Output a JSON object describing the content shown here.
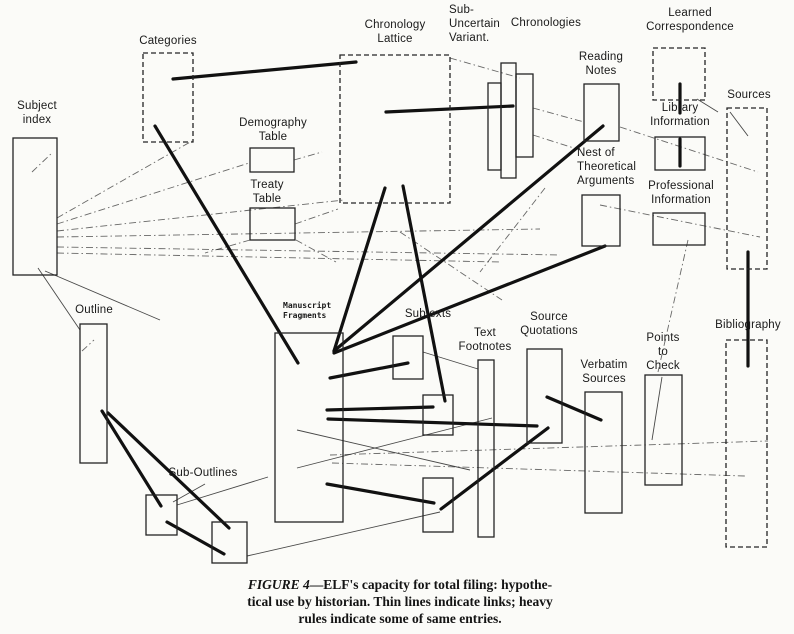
{
  "colors": {
    "paper": "#fbfbf8",
    "ink": "#1b1b1b"
  },
  "caption": {
    "figure_label": "FIGURE 4",
    "dash": "—",
    "line1_rest": "ELF's capacity for total filing: hypothe-",
    "line2": "tical use by historian. Thin lines indicate links; heavy",
    "line3": "rules indicate some of same entries."
  },
  "diagram": {
    "nodes": [
      {
        "id": "subject-index",
        "label": "Subject\nindex",
        "lx": 6,
        "ly": 100,
        "lw": 62,
        "boxes": [
          [
            13,
            138,
            44,
            137,
            0
          ]
        ]
      },
      {
        "id": "categories",
        "label": "Categories",
        "lx": 136,
        "ly": 35,
        "lw": 64,
        "boxes": [
          [
            143,
            53,
            50,
            89,
            1
          ]
        ]
      },
      {
        "id": "demography-table",
        "label": "Demography\nTable",
        "lx": 234,
        "ly": 117,
        "lw": 78,
        "boxes": [
          [
            250,
            148,
            44,
            24,
            0
          ]
        ]
      },
      {
        "id": "treaty-table",
        "label": "Treaty\nTable",
        "lx": 238,
        "ly": 179,
        "lw": 58,
        "boxes": [
          [
            250,
            208,
            45,
            32,
            0
          ]
        ]
      },
      {
        "id": "chronology-lattice",
        "label": "Chronology\nLattice",
        "lx": 338,
        "ly": 19,
        "lw": 114,
        "boxes": [
          [
            340,
            55,
            110,
            148,
            1
          ]
        ]
      },
      {
        "id": "sub-uncertain-variant",
        "label": "Sub-\nUncertain\nVariant.",
        "lx": 449,
        "ly": 4,
        "lw": 62,
        "align": "left",
        "boxes": []
      },
      {
        "id": "chronologies",
        "label": "Chronologies",
        "lx": 506,
        "ly": 17,
        "lw": 80,
        "boxes": [
          [
            488,
            83,
            13,
            87,
            0
          ],
          [
            501,
            63,
            15,
            115,
            0
          ],
          [
            516,
            74,
            17,
            83,
            0
          ]
        ]
      },
      {
        "id": "reading-notes",
        "label": "Reading\nNotes",
        "lx": 570,
        "ly": 51,
        "lw": 62,
        "boxes": [
          [
            584,
            84,
            35,
            57,
            0
          ]
        ]
      },
      {
        "id": "learned-correspondence",
        "label": "Learned\nCorrespondence",
        "lx": 640,
        "ly": 7,
        "lw": 100,
        "boxes": [
          [
            653,
            48,
            52,
            52,
            1
          ]
        ]
      },
      {
        "id": "library-information",
        "label": "Library\nInformation",
        "lx": 642,
        "ly": 102,
        "lw": 76,
        "boxes": [
          [
            655,
            137,
            50,
            33,
            0
          ]
        ]
      },
      {
        "id": "sources",
        "label": "Sources",
        "lx": 722,
        "ly": 89,
        "lw": 54,
        "boxes": [
          [
            727,
            108,
            40,
            161,
            1
          ]
        ]
      },
      {
        "id": "professional-information",
        "label": "Professional\nInformation",
        "lx": 640,
        "ly": 180,
        "lw": 82,
        "boxes": [
          [
            653,
            213,
            52,
            32,
            0
          ]
        ]
      },
      {
        "id": "nest-of-theoretical-arguments",
        "label": "Nest of\nTheoretical\nArguments",
        "lx": 577,
        "ly": 147,
        "lw": 72,
        "align": "left",
        "boxes": [
          [
            582,
            195,
            38,
            51,
            0
          ]
        ]
      },
      {
        "id": "manuscript-fragments",
        "label": "Manuscript\nFragments",
        "lx": 283,
        "ly": 301,
        "lw": 60,
        "align": "left",
        "mono": true,
        "boxes": [
          [
            275,
            333,
            68,
            189,
            0
          ]
        ]
      },
      {
        "id": "subtexts",
        "label": "Subtexts",
        "lx": 398,
        "ly": 308,
        "lw": 60,
        "boxes": [
          [
            393,
            336,
            30,
            43,
            0
          ],
          [
            423,
            395,
            30,
            40,
            0
          ],
          [
            423,
            478,
            30,
            54,
            0
          ]
        ]
      },
      {
        "id": "text-footnotes",
        "label": "Text\nFootnotes",
        "lx": 452,
        "ly": 327,
        "lw": 66,
        "boxes": [
          [
            478,
            360,
            16,
            177,
            0
          ]
        ]
      },
      {
        "id": "source-quotations",
        "label": "Source\nQuotations",
        "lx": 515,
        "ly": 311,
        "lw": 68,
        "boxes": [
          [
            527,
            349,
            35,
            94,
            0
          ]
        ]
      },
      {
        "id": "verbatim-sources",
        "label": "Verbatim\nSources",
        "lx": 572,
        "ly": 359,
        "lw": 64,
        "boxes": [
          [
            585,
            392,
            37,
            121,
            0
          ]
        ]
      },
      {
        "id": "points-to-check",
        "label": "Points\nto\nCheck",
        "lx": 638,
        "ly": 332,
        "lw": 50,
        "boxes": [
          [
            645,
            375,
            37,
            110,
            0
          ]
        ]
      },
      {
        "id": "bibliography",
        "label": "Bibliography",
        "lx": 708,
        "ly": 319,
        "lw": 80,
        "boxes": [
          [
            726,
            340,
            41,
            207,
            1
          ]
        ]
      },
      {
        "id": "outline",
        "label": "Outline",
        "lx": 68,
        "ly": 304,
        "lw": 52,
        "boxes": [
          [
            80,
            324,
            27,
            139,
            0
          ]
        ]
      },
      {
        "id": "sub-outlines",
        "label": "Sub-Outlines",
        "lx": 162,
        "ly": 467,
        "lw": 82,
        "boxes": [
          [
            146,
            495,
            31,
            40,
            0
          ],
          [
            212,
            522,
            35,
            41,
            0
          ]
        ]
      }
    ],
    "heavy_lines": [
      [
        173,
        79,
        356,
        62
      ],
      [
        155,
        126,
        298,
        363
      ],
      [
        386,
        112,
        513,
        106
      ],
      [
        385,
        188,
        334,
        351
      ],
      [
        403,
        186,
        445,
        401
      ],
      [
        334,
        351,
        603,
        126
      ],
      [
        334,
        353,
        605,
        246
      ],
      [
        330,
        378,
        408,
        363
      ],
      [
        327,
        410,
        433,
        407
      ],
      [
        328,
        419,
        537,
        426
      ],
      [
        327,
        484,
        434,
        503
      ],
      [
        441,
        509,
        548,
        428
      ],
      [
        547,
        397,
        601,
        420
      ],
      [
        680,
        84,
        680,
        113
      ],
      [
        680,
        139,
        680,
        166
      ],
      [
        748,
        252,
        748,
        366
      ],
      [
        102,
        411,
        161,
        506
      ],
      [
        108,
        413,
        229,
        528
      ],
      [
        167,
        522,
        224,
        554
      ]
    ],
    "thin_lines": [
      [
        57,
        218,
        192,
        141,
        1
      ],
      [
        57,
        224,
        249,
        163,
        1
      ],
      [
        57,
        231,
        344,
        200,
        1
      ],
      [
        57,
        237,
        540,
        229,
        1
      ],
      [
        57,
        247,
        560,
        255,
        1
      ],
      [
        57,
        253,
        500,
        262,
        1
      ],
      [
        38,
        268,
        80,
        330,
        0
      ],
      [
        45,
        271,
        160,
        320,
        0
      ],
      [
        32,
        172,
        53,
        152,
        1
      ],
      [
        82,
        351,
        94,
        340,
        1
      ],
      [
        294,
        160,
        322,
        152,
        1
      ],
      [
        295,
        224,
        338,
        209,
        1
      ],
      [
        250,
        240,
        205,
        253,
        1
      ],
      [
        296,
        240,
        336,
        262,
        1
      ],
      [
        450,
        58,
        520,
        78,
        1
      ],
      [
        533,
        108,
        584,
        122,
        1
      ],
      [
        533,
        135,
        580,
        150,
        1
      ],
      [
        620,
        127,
        758,
        172,
        1
      ],
      [
        600,
        205,
        760,
        237,
        1
      ],
      [
        697,
        99,
        718,
        112,
        0
      ],
      [
        730,
        112,
        748,
        136,
        0
      ],
      [
        688,
        240,
        658,
        372,
        1
      ],
      [
        662,
        377,
        652,
        440,
        0
      ],
      [
        423,
        352,
        478,
        369,
        0
      ],
      [
        400,
        232,
        502,
        300,
        1
      ],
      [
        545,
        188,
        480,
        272,
        1
      ],
      [
        297,
        468,
        492,
        418,
        0
      ],
      [
        297,
        430,
        470,
        470,
        0
      ],
      [
        330,
        455,
        768,
        441,
        1
      ],
      [
        332,
        463,
        745,
        476,
        1
      ],
      [
        247,
        556,
        440,
        512,
        0
      ],
      [
        205,
        484,
        173,
        502,
        0
      ],
      [
        177,
        505,
        268,
        477,
        0
      ]
    ]
  }
}
